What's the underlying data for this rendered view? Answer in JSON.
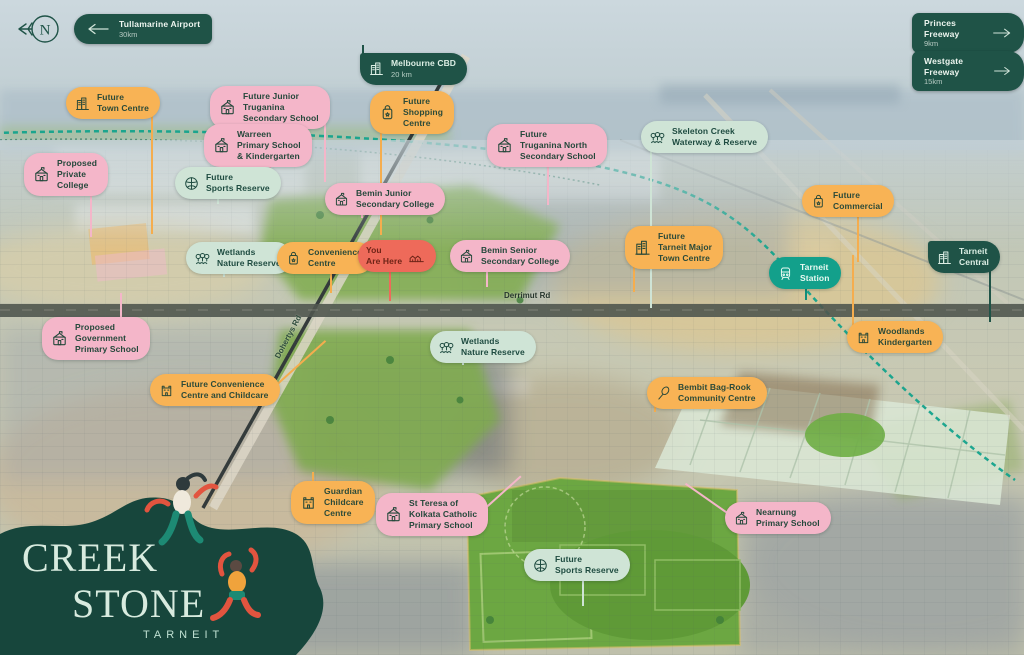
{
  "brand": {
    "line1": "CREEK",
    "line2": "STONE",
    "location": "TARNEIT"
  },
  "compass": {
    "letter": "N"
  },
  "roads": {
    "derrimut": "Derrimut Rd",
    "dohertys": "Dohertys Rd"
  },
  "colors": {
    "dark_green": "#1f5347",
    "pink": "#f4b6c9",
    "orange": "#f8b355",
    "mint": "#cfe4d6",
    "teal": "#13a08b",
    "red": "#ee6a5a",
    "creek": "#13a38c"
  },
  "direction_signs": [
    {
      "id": "tullamarine-airport",
      "label": "Tullamarine Airport",
      "distance": "30km",
      "arrow": "left",
      "x": 74,
      "y": 14
    },
    {
      "id": "princes-freeway",
      "label": "Princes Freeway",
      "distance": "9km",
      "arrow": "right",
      "x": 912,
      "y": 13
    },
    {
      "id": "westgate-freeway",
      "label": "Westgate Freeway",
      "distance": "15km",
      "arrow": "right",
      "x": 912,
      "y": 51
    }
  ],
  "map_labels": [
    {
      "id": "melbourne-cbd",
      "x": 360,
      "y": 53,
      "variant": "green",
      "icon": "buildings",
      "lines": [
        "Melbourne CBD"
      ],
      "sub": "20 km",
      "stem": {
        "dir": "up",
        "len": 14,
        "at": 0.02
      }
    },
    {
      "id": "future-town-centre",
      "x": 66,
      "y": 87,
      "variant": "orange",
      "icon": "buildings",
      "lines": [
        "Future",
        "Town Centre"
      ],
      "stem": {
        "dir": "down",
        "len": 128,
        "at": 0.9
      }
    },
    {
      "id": "future-junior-truganina-secondary-school",
      "x": 210,
      "y": 86,
      "variant": "pink",
      "icon": "school",
      "lines": [
        "Future Junior",
        "Truganina",
        "Secondary School"
      ],
      "stem": {
        "dir": "down",
        "len": 70,
        "at": 0.95
      }
    },
    {
      "id": "warreen-primary-school-kindergarten",
      "x": 204,
      "y": 124,
      "variant": "pink",
      "icon": "school",
      "lines": [
        "Warreen",
        "Primary School",
        "& Kindergarten"
      ],
      "stem": {
        "dir": "down",
        "len": 40,
        "at": 0.6
      }
    },
    {
      "id": "proposed-private-college",
      "x": 24,
      "y": 153,
      "variant": "pink",
      "icon": "school",
      "lines": [
        "Proposed",
        "Private",
        "College"
      ],
      "stem": {
        "dir": "down",
        "len": 58,
        "at": 0.78
      }
    },
    {
      "id": "future-sports-reserve-north",
      "x": 175,
      "y": 167,
      "variant": "mint",
      "icon": "basketball",
      "lines": [
        "Future",
        "Sports Reserve"
      ],
      "stem": {
        "dir": "down",
        "len": 18,
        "at": 0.4
      }
    },
    {
      "id": "future-shopping-centre",
      "x": 370,
      "y": 91,
      "variant": "orange",
      "icon": "bag",
      "lines": [
        "Future",
        "Shopping",
        "Centre"
      ],
      "stem": {
        "dir": "down",
        "len": 118,
        "at": 0.12
      }
    },
    {
      "id": "future-truganina-north-secondary-school",
      "x": 487,
      "y": 124,
      "variant": "pink",
      "icon": "school",
      "lines": [
        "Future",
        "Truganina North",
        "Secondary School"
      ],
      "stem": {
        "dir": "down",
        "len": 55,
        "at": 0.5
      }
    },
    {
      "id": "skeleton-creek-waterway-reserve",
      "x": 641,
      "y": 121,
      "variant": "mint",
      "icon": "trees",
      "lines": [
        "Skeleton Creek",
        "Waterway & Reserve"
      ],
      "stem": {
        "dir": "down",
        "len": 168,
        "at": 0.07
      }
    },
    {
      "id": "bemin-junior-secondary-college",
      "x": 325,
      "y": 183,
      "variant": "pink",
      "icon": "school",
      "lines": [
        "Bemin Junior",
        "Secondary College"
      ],
      "stem": {
        "dir": "down",
        "len": 16,
        "at": 0.3
      }
    },
    {
      "id": "future-commercial",
      "x": 802,
      "y": 185,
      "variant": "orange",
      "icon": "bag",
      "lines": [
        "Future",
        "Commercial"
      ],
      "stem": {
        "dir": "down",
        "len": 58,
        "at": 0.6
      }
    },
    {
      "id": "wetlands-nature-reserve-north",
      "x": 186,
      "y": 242,
      "variant": "mint",
      "icon": "trees",
      "lines": [
        "Wetlands",
        "Nature Reserve"
      ],
      "stem": {
        "dir": "down",
        "len": 16,
        "at": 0.35
      }
    },
    {
      "id": "convenience-centre",
      "x": 277,
      "y": 242,
      "variant": "orange",
      "icon": "bag",
      "lines": [
        "Convenience",
        "Centre"
      ],
      "stem": {
        "dir": "down",
        "len": 32,
        "at": 0.55
      }
    },
    {
      "id": "you-are-here",
      "x": 358,
      "y": 240,
      "variant": "red",
      "icon": "houses",
      "icon_side": "right",
      "lines": [
        "You",
        "Are Here"
      ],
      "stem": {
        "dir": "down",
        "len": 42,
        "at": 0.4
      }
    },
    {
      "id": "bemin-senior-secondary-college",
      "x": 450,
      "y": 240,
      "variant": "pink",
      "icon": "school",
      "lines": [
        "Bemin Senior",
        "Secondary College"
      ],
      "stem": {
        "dir": "down",
        "len": 28,
        "at": 0.3
      }
    },
    {
      "id": "future-tarneit-major-town-centre",
      "x": 625,
      "y": 226,
      "variant": "orange",
      "icon": "buildings",
      "lines": [
        "Future",
        "Tarneit Major",
        "Town Centre"
      ],
      "stem": {
        "dir": "down",
        "len": 40,
        "at": 0.08
      }
    },
    {
      "id": "tarneit-station",
      "x": 769,
      "y": 257,
      "variant": "teal",
      "icon": "train",
      "lines": [
        "Tarneit",
        "Station"
      ],
      "stem": {
        "dir": "down",
        "len": 24,
        "at": 0.5
      }
    },
    {
      "id": "tarneit-central",
      "x": 928,
      "y": 241,
      "variant": "green",
      "icon": "buildings",
      "lines": [
        "Tarneit",
        "Central"
      ],
      "stem": {
        "dir": "down",
        "len": 62,
        "at": 0.85
      }
    },
    {
      "id": "proposed-government-primary-school",
      "x": 42,
      "y": 317,
      "variant": "pink",
      "icon": "school",
      "lines": [
        "Proposed",
        "Government",
        "Primary School"
      ],
      "stem": {
        "dir": "up",
        "len": 30,
        "at": 0.72
      }
    },
    {
      "id": "woodlands-kindergarten",
      "x": 847,
      "y": 321,
      "variant": "orange",
      "icon": "castle",
      "lines": [
        "Woodlands",
        "Kindergarten"
      ],
      "stem": {
        "dir": "up",
        "len": 72,
        "at": 0.05
      }
    },
    {
      "id": "wetlands-nature-reserve-south",
      "x": 430,
      "y": 331,
      "variant": "mint",
      "icon": "trees",
      "lines": [
        "Wetlands",
        "Nature Reserve"
      ],
      "stem": {
        "dir": "down",
        "len": 15,
        "at": 0.3
      }
    },
    {
      "id": "future-convenience-centre-and-childcare",
      "x": 150,
      "y": 374,
      "variant": "orange",
      "icon": "castle",
      "lines": [
        "Future Convenience",
        "Centre and Childcare"
      ],
      "stem": {
        "dir": "diag-ur",
        "len": 72
      }
    },
    {
      "id": "bembit-bag-rook-community-centre",
      "x": 647,
      "y": 377,
      "variant": "orange",
      "icon": "tennis",
      "lines": [
        "Bembit Bag-Rook",
        "Community Centre"
      ],
      "stem": {
        "dir": "down",
        "len": 16,
        "at": 0.06
      }
    },
    {
      "id": "guardian-childcare-centre",
      "x": 291,
      "y": 481,
      "variant": "orange",
      "icon": "castle",
      "lines": [
        "Guardian",
        "Childcare",
        "Centre"
      ],
      "stem": {
        "dir": "up",
        "len": 15,
        "at": 0.25
      }
    },
    {
      "id": "st-teresa-of-kolkata-catholic-primary-school",
      "x": 376,
      "y": 493,
      "variant": "pink",
      "icon": "school",
      "lines": [
        "St Teresa of",
        "Kolkata Catholic",
        "Primary School"
      ],
      "stem": {
        "dir": "diag-ur",
        "len": 55
      }
    },
    {
      "id": "nearnung-primary-school",
      "x": 725,
      "y": 502,
      "variant": "pink",
      "icon": "school",
      "lines": [
        "Nearnung",
        "Primary School"
      ],
      "stem": {
        "dir": "diag-ul",
        "len": 58
      }
    },
    {
      "id": "future-sports-reserve-south",
      "x": 524,
      "y": 549,
      "variant": "mint",
      "icon": "basketball",
      "lines": [
        "Future",
        "Sports Reserve"
      ],
      "stem": {
        "dir": "down",
        "len": 38,
        "at": 0.55
      }
    }
  ]
}
